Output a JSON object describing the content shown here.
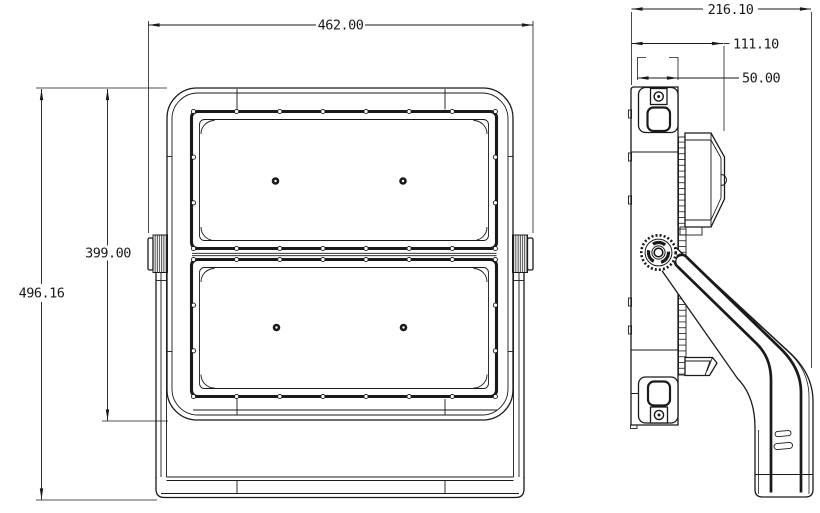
{
  "drawing": {
    "type": "engineering-dimension-drawing",
    "subject": "LED floodlight, front and side orthographic views",
    "background_color": "#ffffff",
    "line_color": "#1a1a1a",
    "front_view": {
      "width": "462.00",
      "opening_height": "399.00",
      "overall_height": "496.16"
    },
    "side_view": {
      "overall_depth": "216.10",
      "housing_depth": "111.10",
      "bracket_spacing": "50.00"
    }
  }
}
